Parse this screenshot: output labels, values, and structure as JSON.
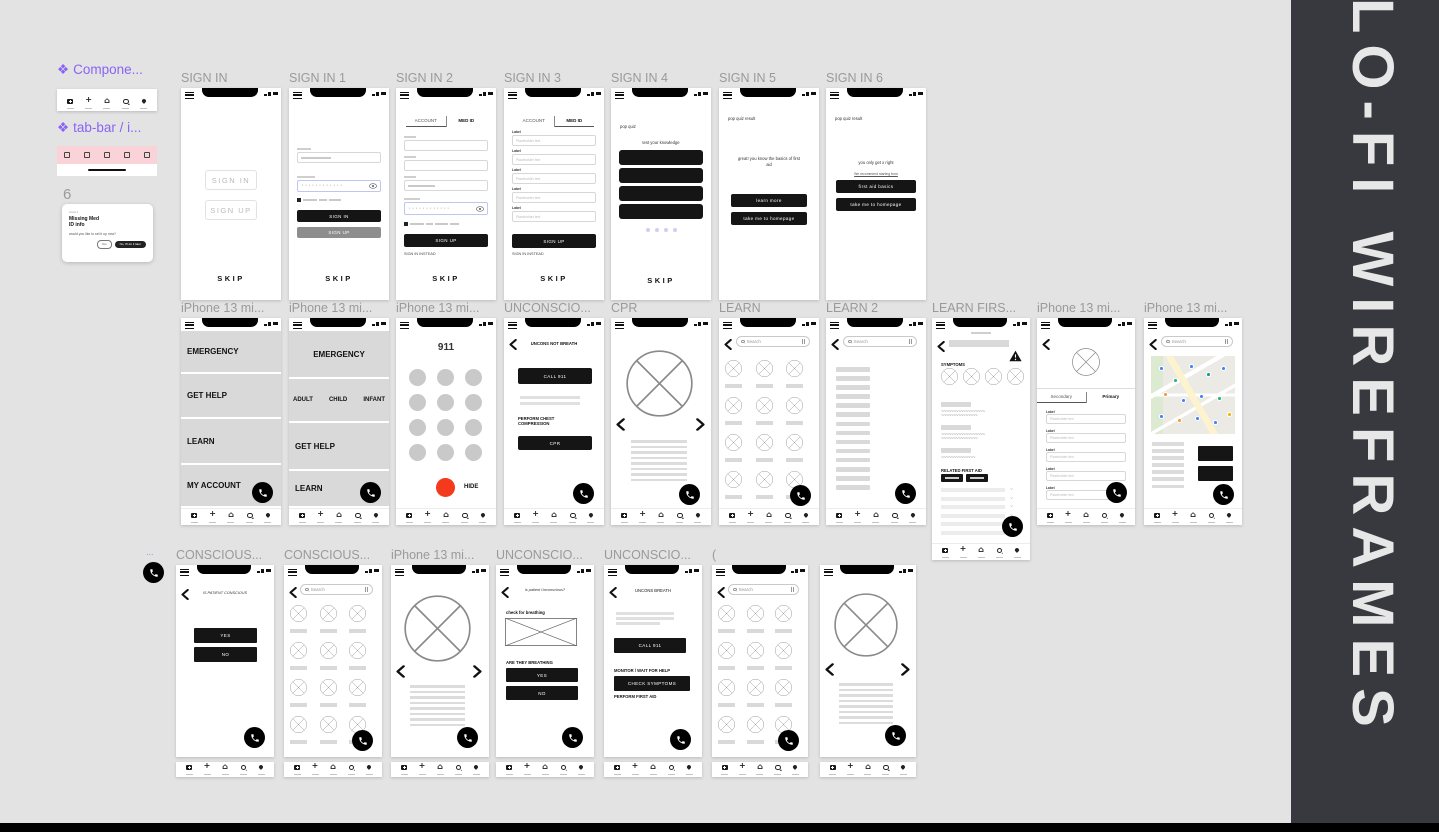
{
  "sidebar": {
    "title": "LO-FI WIREFRAMES"
  },
  "colors": {
    "accent_purple": "#8A63F5",
    "component_pink": "#F9D3D8",
    "dial_red": "#F4391C",
    "dot_purple": "#D7CBF2",
    "sidebar_bg": "#37393E",
    "canvas_bg": "#E3E3E3",
    "wire_gray": "#D9D9D9"
  },
  "common": {
    "search": "Search",
    "label": "Label",
    "placeholder": "Placeholder text",
    "skip": "SKIP",
    "yes": "YES",
    "no": "NO",
    "call911": "CALL 911"
  },
  "components": {
    "main_label": "Compone...",
    "tabbar_label": "tab-bar / i...",
    "note_number": "6",
    "fab_label": "...",
    "card": {
      "eyebrow": "Card 1",
      "title_line1": "Missing Med",
      "title_line2": "ID info",
      "body": "would you like to set it up now?",
      "btn_yes": "Yes",
      "btn_later": "No, I'll do it later"
    }
  },
  "frames": {
    "s0": {
      "title": "SIGN IN",
      "signin": "SIGN IN",
      "signup": "SIGN UP"
    },
    "s1": {
      "title": "SIGN IN 1",
      "signin": "SIGN IN",
      "signup": "SIGN UP",
      "pwdots": "············"
    },
    "s2": {
      "title": "SIGN IN 2",
      "tab_account": "ACCOUNT",
      "tab_medid": "MED ID",
      "signup": "SIGN UP",
      "instead": "SIGN IN INSTEAD",
      "pwdots": "············"
    },
    "s3": {
      "title": "SIGN IN 3",
      "tab_account": "ACCOUNT",
      "tab_medid": "MED ID",
      "signup": "SIGN UP",
      "instead": "SIGN IN INSTEAD"
    },
    "s4": {
      "title": "SIGN IN 4",
      "eyebrow": "pop quiz",
      "heading": "test your knowledge"
    },
    "s5": {
      "title": "SIGN IN 5",
      "eyebrow": "pop quiz result",
      "message": "great! you know the basics of first aid",
      "btn_learn": "learn more",
      "btn_home": "take me to homepage"
    },
    "s6": {
      "title": "SIGN IN 6",
      "eyebrow": "pop quiz result",
      "message": "you only get x right",
      "note": "We recommend starting from",
      "btn_basics": "first aid basics",
      "btn_home": "take me to homepage"
    },
    "m1": {
      "title": "iPhone 13 mi...",
      "items": [
        "EMERGENCY",
        "GET HELP",
        "LEARN",
        "MY ACCOUNT"
      ]
    },
    "m2": {
      "title": "iPhone 13 mi...",
      "emergency": "EMERGENCY",
      "sub": [
        "ADULT",
        "CHILD",
        "INFANT"
      ],
      "gethelp": "GET HELP",
      "learn": "LEARN"
    },
    "dial": {
      "title": "iPhone 13 mi...",
      "number": "911",
      "hide": "HIDE"
    },
    "u1": {
      "title": "UNCONSCIO...",
      "heading": "UNCONS NOT BREATH",
      "chest": "PERFORM CHEST COMPRESSION",
      "cpr": "CPR"
    },
    "cpr": {
      "title": "CPR"
    },
    "learn": {
      "title": "LEARN"
    },
    "learn2": {
      "title": "LEARN 2"
    },
    "lf": {
      "title": "LEARN FIRS...",
      "symptoms": "SYMPTOMS",
      "related": "RELATED FIRST AID"
    },
    "prof": {
      "title": "iPhone 13 mi...",
      "tab_secondary": "Secondary",
      "tab_primary": "Primary"
    },
    "map": {
      "title": "iPhone 13 mi..."
    },
    "c1": {
      "title": "CONSCIOUS...",
      "heading": "IS PATIENT CONSCIOUS"
    },
    "c2": {
      "title": "CONSCIOUS..."
    },
    "img1": {
      "title": "iPhone 13 mi..."
    },
    "u2": {
      "title": "UNCONSCIO...",
      "heading": "is patient Unconscious?",
      "check": "check for breathing",
      "breathing": "ARE THEY BREATHING"
    },
    "u3": {
      "title": "UNCONSCIO...",
      "heading": "UNCONS BREATH",
      "monitor": "MONITOR / WAIT FOR HELP",
      "symptoms": "CHECK SYMPTOMS",
      "firstaid": "PERFORM FIRST AID"
    },
    "paren": {
      "title": "("
    }
  }
}
